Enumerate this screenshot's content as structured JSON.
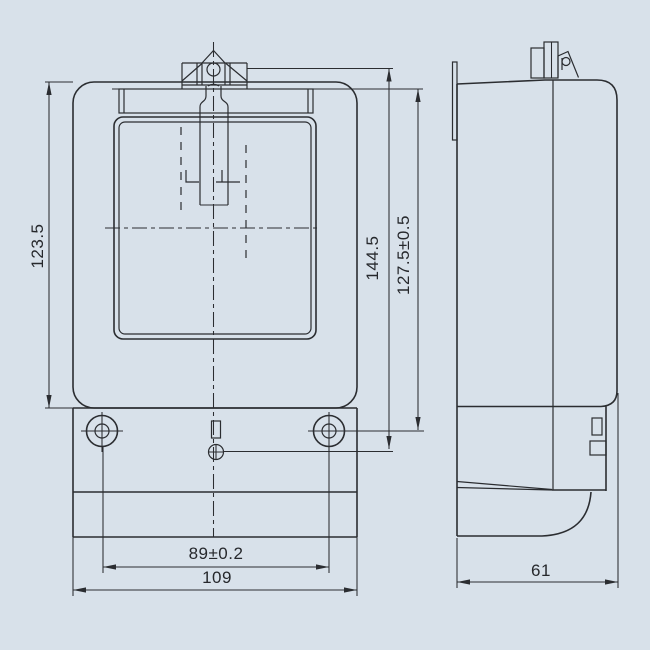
{
  "drawing": {
    "type": "technical-dimension-drawing",
    "dimensions": {
      "body_height": "123.5",
      "total_height": "144.5",
      "hook_to_mount_height": "127.5±0.5",
      "mount_hole_spacing": "89±0.2",
      "body_width": "109",
      "body_depth": "61"
    },
    "colors": {
      "background": "#d8e1ea",
      "line": "#2b2d31"
    }
  }
}
